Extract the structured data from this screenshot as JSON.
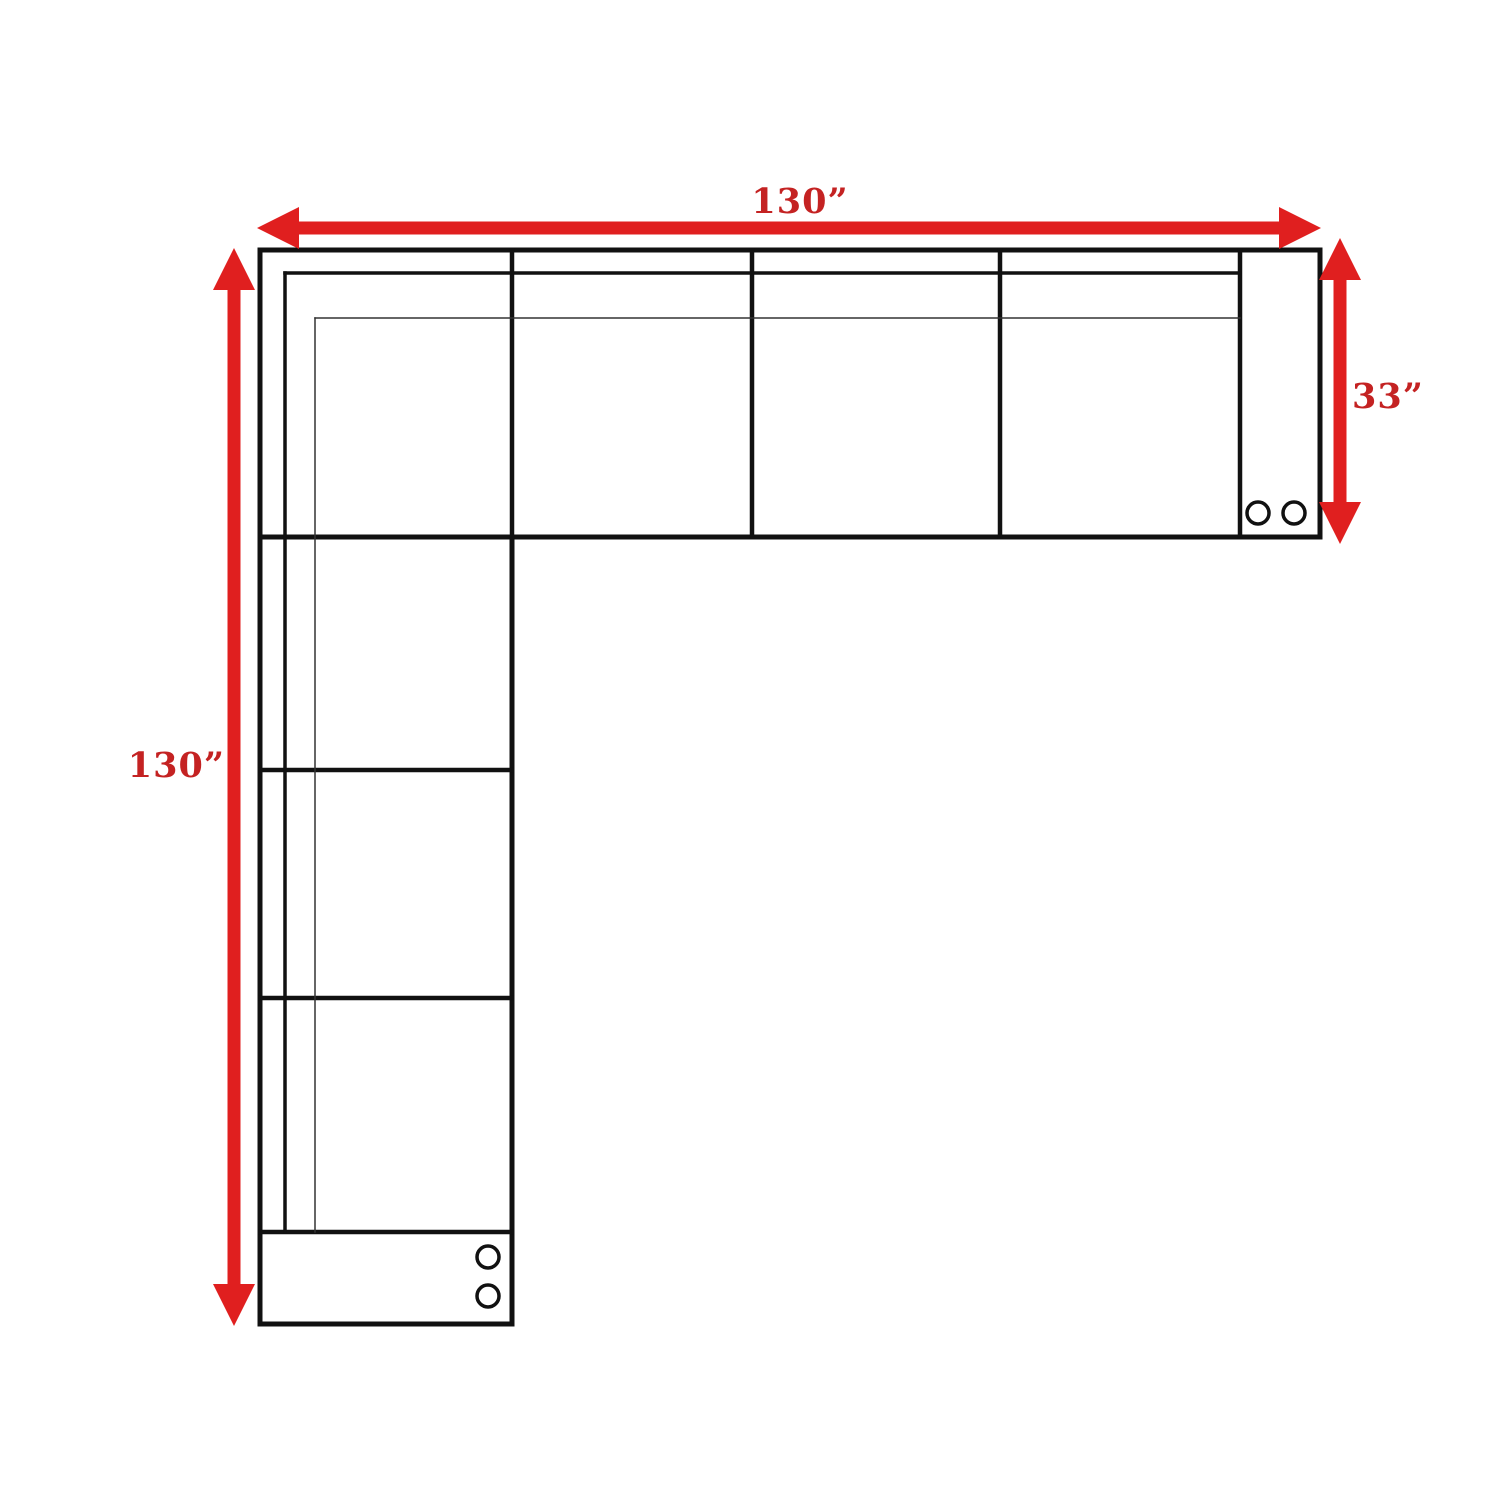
{
  "dimensions": {
    "top": {
      "label": "130”",
      "value": 130,
      "unit": "inches"
    },
    "left": {
      "label": "130”",
      "value": 130,
      "unit": "inches"
    },
    "right": {
      "label": "33”",
      "value": 33,
      "unit": "inches"
    }
  },
  "colors": {
    "arrow_red": "#e01f1f",
    "label_red": "#c42222",
    "line_black": "#111111",
    "thin_line": "#333333",
    "background": "#ffffff"
  },
  "floorplan": {
    "shape": "L-shaped sectional",
    "horizontal_seat_dividers": 4,
    "vertical_seat_dividers": 3,
    "caster_circles_right_armrest": 2,
    "caster_circles_bottom_armrest": 2
  }
}
